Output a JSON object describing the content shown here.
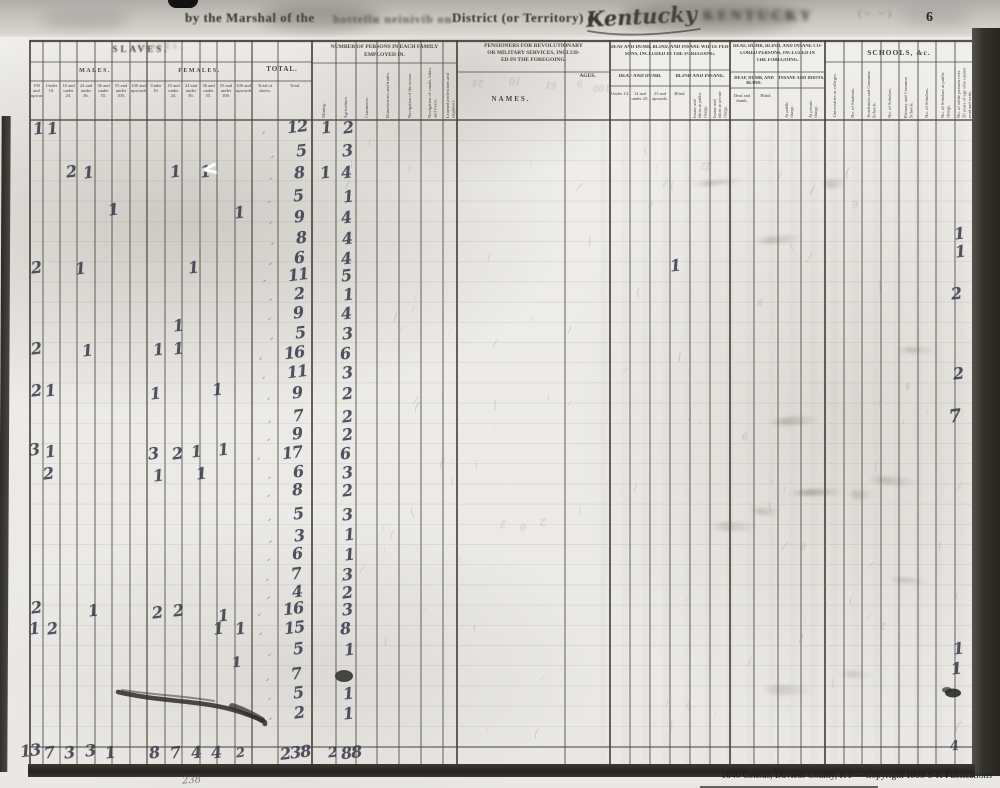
{
  "page": {
    "top_line": {
      "by": "by the Marshal of the",
      "ghost": "hottelln neinivib on",
      "district": "District (or Territory) of",
      "territory": "Kentucky",
      "stamp": "KENTUCKY",
      "corner_note": "( ~ . ~ )",
      "page_number": "6"
    },
    "caption": "1840 Census, Daviess County, KY— Copyright 1999 S-K Publications",
    "margin_note": "238"
  },
  "header": {
    "slaves": {
      "title": "SLAVES.",
      "males": "MALES.",
      "females": "FEMALES.",
      "margin_col": "100 and upwards.",
      "age_cols": [
        "Under 10.",
        "10 and under 24.",
        "24 and under 36.",
        "36 and under 55.",
        "55 and under 100.",
        "100 and upwards.",
        "Under 10.",
        "10 and under 24.",
        "24 and under 36.",
        "36 and under 55.",
        "55 and under 100.",
        "100 and upwards."
      ]
    },
    "total": {
      "title": "TOTAL.",
      "cols": [
        "Total of slaves.",
        "Total."
      ]
    },
    "employed": {
      "title": [
        "NUMBER OF PERSONS IN EACH FAMILY",
        "EMPLOYED IN."
      ],
      "cols": [
        "Mining.",
        "Agriculture.",
        "Commerce.",
        "Manufactures and trades.",
        "Navigation of the ocean.",
        "Navigation of canals, lakes, and rivers.",
        "Learned professions and engineers."
      ]
    },
    "pensioners": {
      "title": [
        "PENSIONERS FOR REVOLUTIONARY",
        "OR MILITARY SERVICES, INCLUD-",
        "ED IN THE FOREGOING."
      ],
      "names": "NAMES.",
      "ages": "AGES."
    },
    "deaf_white": {
      "title": [
        "DEAF AND DUMB, BLIND, AND INSANE WHITE PER-",
        "SONS, INCLUDED IN THE FOREGOING."
      ],
      "groups": [
        "DEAF AND DUMB.",
        "BLIND AND INSANE."
      ],
      "cols": [
        "Under 14.",
        "14 and under 25.",
        "25 and upwards.",
        "Blind.",
        "Insane and idiots at public charge.",
        "Insane and idiots at private charge."
      ]
    },
    "deaf_colored": {
      "title": [
        "DEAF, DUMB, BLIND, AND INSANE CO-",
        "LORED PERSONS, INCLUDED IN",
        "THE FOREGOING."
      ],
      "groups": [
        "DEAF, DUMB, AND BLIND.",
        "INSANE AND IDIOTS."
      ],
      "cols": [
        "Deaf and dumb.",
        "Blind.",
        "At public charge.",
        "At private charge."
      ]
    },
    "schools": {
      "title": "SCHOOLS, &c.",
      "cols": [
        "Universities or colleges.",
        "No. of Students.",
        "Academies and Grammar Schools.",
        "No. of Scholars.",
        "Primary and Common Schools.",
        "No. of Scholars.",
        "No. of Scholars at public charge.",
        "No. of white persons over 20 years of age who cannot read and write."
      ]
    }
  },
  "ink_marks": [
    [
      33,
      121,
      "1"
    ],
    [
      47,
      121,
      "1"
    ],
    [
      66,
      164,
      "2"
    ],
    [
      83,
      165,
      "1"
    ],
    [
      170,
      164,
      "1"
    ],
    [
      200,
      164,
      "1"
    ],
    [
      108,
      202,
      "1"
    ],
    [
      234,
      205,
      "1"
    ],
    [
      31,
      260,
      "2"
    ],
    [
      75,
      261,
      "1"
    ],
    [
      188,
      260,
      "1"
    ],
    [
      173,
      318,
      "1"
    ],
    [
      31,
      341,
      "2"
    ],
    [
      82,
      343,
      "1"
    ],
    [
      153,
      342,
      "1"
    ],
    [
      173,
      341,
      "1"
    ],
    [
      31,
      383,
      "2"
    ],
    [
      45,
      383,
      "1"
    ],
    [
      150,
      386,
      "1"
    ],
    [
      212,
      382,
      "1"
    ],
    [
      29,
      442,
      "3"
    ],
    [
      45,
      444,
      "1"
    ],
    [
      148,
      446,
      "3"
    ],
    [
      172,
      446,
      "2"
    ],
    [
      191,
      444,
      "1"
    ],
    [
      218,
      442,
      "1"
    ],
    [
      43,
      466,
      "2"
    ],
    [
      153,
      468,
      "1"
    ],
    [
      196,
      466,
      "1"
    ],
    [
      31,
      600,
      "2"
    ],
    [
      88,
      603,
      "1"
    ],
    [
      152,
      605,
      "2"
    ],
    [
      173,
      603,
      "2"
    ],
    [
      218,
      608,
      "1"
    ],
    [
      29,
      621,
      "1"
    ],
    [
      47,
      621,
      "2"
    ],
    [
      213,
      621,
      "1"
    ],
    [
      235,
      621,
      "1"
    ],
    [
      232,
      656,
      "1",
      14
    ],
    [
      287,
      119,
      "12"
    ],
    [
      296,
      143,
      "5"
    ],
    [
      294,
      165,
      "8"
    ],
    [
      293,
      188,
      "5"
    ],
    [
      294,
      209,
      "9"
    ],
    [
      296,
      230,
      "8"
    ],
    [
      294,
      250,
      "6"
    ],
    [
      288,
      267,
      "11"
    ],
    [
      294,
      286,
      "2"
    ],
    [
      293,
      305,
      "9"
    ],
    [
      295,
      325,
      "5"
    ],
    [
      284,
      345,
      "16"
    ],
    [
      287,
      364,
      "11"
    ],
    [
      292,
      385,
      "9"
    ],
    [
      293,
      408,
      "7"
    ],
    [
      292,
      426,
      "9"
    ],
    [
      282,
      445,
      "17"
    ],
    [
      293,
      464,
      "6"
    ],
    [
      292,
      482,
      "8"
    ],
    [
      293,
      506,
      "5"
    ],
    [
      294,
      528,
      "3"
    ],
    [
      292,
      546,
      "6"
    ],
    [
      291,
      566,
      "7"
    ],
    [
      292,
      584,
      "4"
    ],
    [
      283,
      601,
      "16"
    ],
    [
      284,
      620,
      "15"
    ],
    [
      293,
      641,
      "5"
    ],
    [
      291,
      666,
      "7"
    ],
    [
      293,
      685,
      "5"
    ],
    [
      294,
      705,
      "2"
    ],
    [
      321,
      120,
      "1"
    ],
    [
      320,
      165,
      "1"
    ],
    [
      343,
      120,
      "2"
    ],
    [
      342,
      143,
      "3"
    ],
    [
      341,
      165,
      "4"
    ],
    [
      343,
      189,
      "1"
    ],
    [
      341,
      210,
      "4"
    ],
    [
      342,
      231,
      "4"
    ],
    [
      341,
      251,
      "4"
    ],
    [
      341,
      268,
      "5"
    ],
    [
      343,
      287,
      "1"
    ],
    [
      341,
      306,
      "4"
    ],
    [
      342,
      326,
      "3"
    ],
    [
      340,
      346,
      "6"
    ],
    [
      342,
      365,
      "3"
    ],
    [
      342,
      386,
      "2"
    ],
    [
      342,
      409,
      "2"
    ],
    [
      342,
      427,
      "2"
    ],
    [
      340,
      446,
      "6"
    ],
    [
      342,
      465,
      "3"
    ],
    [
      342,
      483,
      "2"
    ],
    [
      342,
      507,
      "3"
    ],
    [
      344,
      527,
      "1"
    ],
    [
      344,
      547,
      "1"
    ],
    [
      342,
      567,
      "3"
    ],
    [
      342,
      585,
      "2"
    ],
    [
      342,
      602,
      "3"
    ],
    [
      340,
      621,
      "8"
    ],
    [
      344,
      642,
      "1"
    ],
    [
      343,
      686,
      "1"
    ],
    [
      343,
      706,
      "1"
    ],
    [
      670,
      258,
      "1"
    ],
    [
      954,
      226,
      "1"
    ],
    [
      955,
      244,
      "1"
    ],
    [
      951,
      286,
      "2"
    ],
    [
      953,
      366,
      "2"
    ],
    [
      949,
      408,
      "7",
      18
    ],
    [
      953,
      641,
      "1"
    ],
    [
      951,
      661,
      "1"
    ],
    [
      950,
      740,
      "4",
      13
    ],
    [
      20,
      743,
      "13"
    ],
    [
      44,
      745,
      "7"
    ],
    [
      64,
      745,
      "3"
    ],
    [
      85,
      743,
      "3"
    ],
    [
      105,
      745,
      "1"
    ],
    [
      149,
      745,
      "8"
    ],
    [
      170,
      745,
      "7"
    ],
    [
      191,
      745,
      "4"
    ],
    [
      211,
      745,
      "4"
    ],
    [
      236,
      747,
      "2",
      13
    ],
    [
      280,
      745,
      "238"
    ],
    [
      328,
      746,
      "2",
      14
    ],
    [
      341,
      745,
      "88"
    ]
  ],
  "white_mark": {
    "x": 202,
    "y": 160,
    "t": "<"
  },
  "ghost_marks": [
    [
      472,
      77,
      "24"
    ],
    [
      509,
      75,
      "10"
    ],
    [
      545,
      79,
      "61"
    ],
    [
      577,
      77,
      "9"
    ],
    [
      593,
      82,
      "100"
    ],
    [
      500,
      518,
      "2"
    ],
    [
      520,
      521,
      "0"
    ],
    [
      540,
      516,
      "2"
    ],
    [
      757,
      296,
      "8"
    ],
    [
      852,
      198,
      "6"
    ],
    [
      700,
      160,
      "22"
    ],
    [
      742,
      430,
      "9"
    ],
    [
      800,
      540,
      "6"
    ],
    [
      880,
      620,
      "2"
    ],
    [
      905,
      380,
      "4"
    ]
  ],
  "ink_color": "#39374a"
}
